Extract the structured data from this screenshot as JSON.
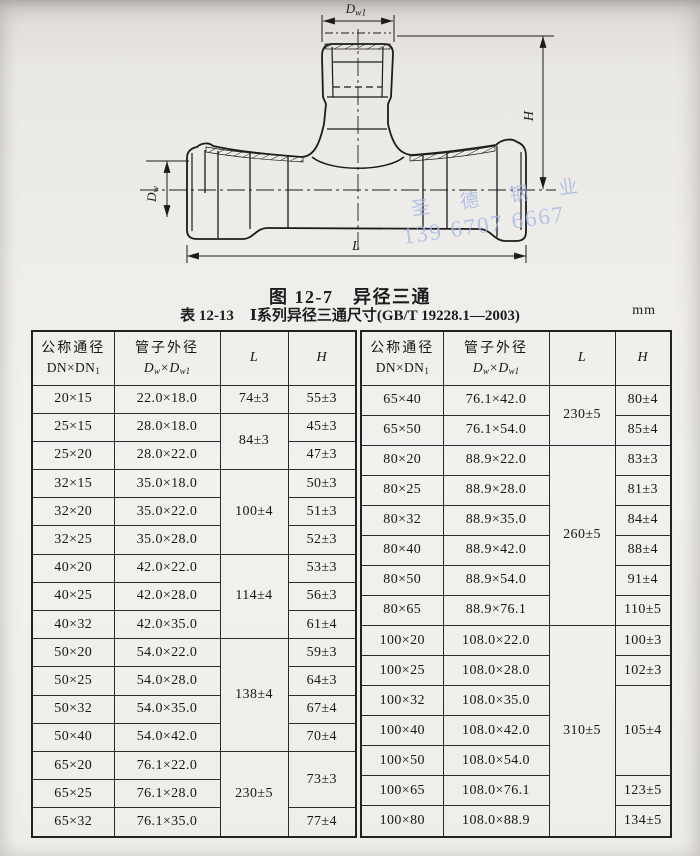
{
  "figure": {
    "caption": "图 12-7　异径三通",
    "labels": {
      "d": "D",
      "sub_w1": "w1",
      "sub_w": "w",
      "h": "H",
      "l": "L"
    },
    "watermark": {
      "line1": "圣 德 钢 业",
      "line2": "139 6707 6667",
      "color": "#a4b9e2"
    }
  },
  "table": {
    "caption_label": "表 12-13",
    "caption_title": "Ⅰ系列异径三通尺寸(GB/T 19228.1—2003)",
    "unit": "mm",
    "headers": {
      "col1_line1": "公称通径",
      "col1_line2": "DN×DN",
      "col1_sub": "1",
      "col2_line1": "管子外径",
      "col2_d": "D",
      "col2_sub1": "w",
      "col2_mid": "×D",
      "col2_sub2": "w1",
      "col_l": "L",
      "col_h": "H"
    },
    "left_rows": [
      {
        "dn": "20×15",
        "dw": "22.0×18.0",
        "l": "74±3",
        "h": "55±3"
      },
      {
        "dn": "25×15",
        "dw": "28.0×18.0",
        "l": "84±3",
        "h": "45±3"
      },
      {
        "dn": "25×20",
        "dw": "28.0×22.0",
        "h": "47±3"
      },
      {
        "dn": "32×15",
        "dw": "35.0×18.0",
        "l": "100±4",
        "h": "50±3"
      },
      {
        "dn": "32×20",
        "dw": "35.0×22.0",
        "h": "51±3"
      },
      {
        "dn": "32×25",
        "dw": "35.0×28.0",
        "h": "52±3"
      },
      {
        "dn": "40×20",
        "dw": "42.0×22.0",
        "l": "114±4",
        "h": "53±3"
      },
      {
        "dn": "40×25",
        "dw": "42.0×28.0",
        "h": "56±3"
      },
      {
        "dn": "40×32",
        "dw": "42.0×35.0",
        "h": "61±4"
      },
      {
        "dn": "50×20",
        "dw": "54.0×22.0",
        "l": "138±4",
        "h": "59±3"
      },
      {
        "dn": "50×25",
        "dw": "54.0×28.0",
        "h": "64±3"
      },
      {
        "dn": "50×32",
        "dw": "54.0×35.0",
        "h": "67±4"
      },
      {
        "dn": "50×40",
        "dw": "54.0×42.0",
        "h": "70±4"
      },
      {
        "dn": "65×20",
        "dw": "76.1×22.0",
        "l": "230±5",
        "h": "73±3"
      },
      {
        "dn": "65×25",
        "dw": "76.1×28.0"
      },
      {
        "dn": "65×32",
        "dw": "76.1×35.0",
        "h": "77±4"
      }
    ],
    "right_rows": [
      {
        "dn": "65×40",
        "dw": "76.1×42.0",
        "l": "230±5",
        "h": "80±4"
      },
      {
        "dn": "65×50",
        "dw": "76.1×54.0",
        "h": "85±4"
      },
      {
        "dn": "80×20",
        "dw": "88.9×22.0",
        "l": "260±5",
        "h": "83±3"
      },
      {
        "dn": "80×25",
        "dw": "88.9×28.0",
        "h": "81±3"
      },
      {
        "dn": "80×32",
        "dw": "88.9×35.0",
        "h": "84±4"
      },
      {
        "dn": "80×40",
        "dw": "88.9×42.0",
        "h": "88±4"
      },
      {
        "dn": "80×50",
        "dw": "88.9×54.0",
        "h": "91±4"
      },
      {
        "dn": "80×65",
        "dw": "88.9×76.1",
        "h": "110±5"
      },
      {
        "dn": "100×20",
        "dw": "108.0×22.0",
        "l": "310±5",
        "h": "100±3"
      },
      {
        "dn": "100×25",
        "dw": "108.0×28.0",
        "h": "102±3"
      },
      {
        "dn": "100×32",
        "dw": "108.0×35.0",
        "h": "105±4"
      },
      {
        "dn": "100×40",
        "dw": "108.0×42.0"
      },
      {
        "dn": "100×50",
        "dw": "108.0×54.0"
      },
      {
        "dn": "100×65",
        "dw": "108.0×76.1",
        "h": "123±5"
      },
      {
        "dn": "100×80",
        "dw": "108.0×88.9",
        "h": "134±5"
      }
    ]
  }
}
